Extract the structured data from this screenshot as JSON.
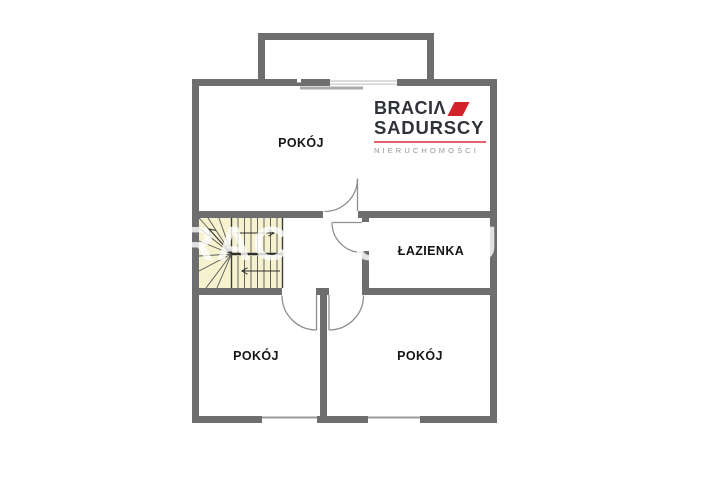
{
  "plan": {
    "rooms": [
      {
        "id": "room-top",
        "label": "POKÓJ"
      },
      {
        "id": "bathroom",
        "label": "ŁAZIENKA"
      },
      {
        "id": "room-bottom-left",
        "label": "POKÓJ"
      },
      {
        "id": "room-bottom-right",
        "label": "POKÓJ"
      }
    ],
    "features": [
      "staircase-with-winders",
      "balcony-top",
      "door-arcs",
      "windows"
    ]
  },
  "brand": {
    "line1_prefix": "BRACI",
    "line1_stylized_a": "Λ",
    "line2": "SADURSCY",
    "line3": "NIERUCHOMOŚCI",
    "mark_icon": "red-parallelogram"
  },
  "watermark": {
    "text": "BRACIA SADURSCY"
  },
  "colors": {
    "wall": "#6e6e6e",
    "stairs_fill": "#f6f2d0",
    "door": "#8f8f8f",
    "window": "#9b9b9b",
    "logo_red": "#d2232a",
    "logo_dark": "#2f3238",
    "logo_rule": "#e2636f",
    "logo_gray": "#949494"
  }
}
